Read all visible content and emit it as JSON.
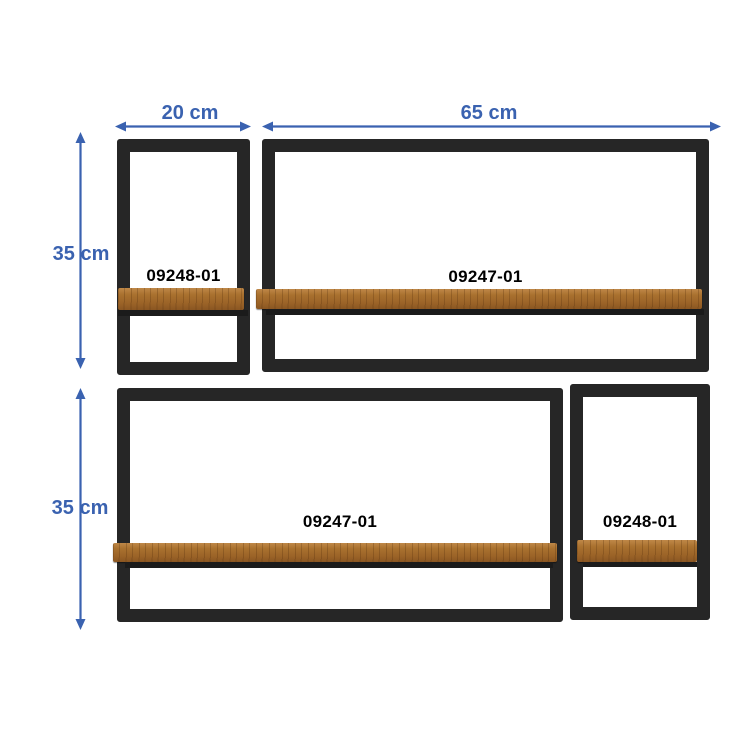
{
  "colors": {
    "dimension_blue": "#3A62B0",
    "frame_black": "#1F1F1F",
    "wood_brown": "#A9712F",
    "background": "#FFFFFF",
    "sku_text": "#000000"
  },
  "dimension_labels": {
    "small_shelf_width": "20 cm",
    "large_shelf_width": "65 cm",
    "top_row_height": "35 cm",
    "bottom_row_height": "35 cm"
  },
  "shelves": {
    "top_small": {
      "sku": "09248-01"
    },
    "top_large": {
      "sku": "09247-01"
    },
    "bottom_large": {
      "sku": "09247-01"
    },
    "bottom_small": {
      "sku": "09248-01"
    }
  }
}
